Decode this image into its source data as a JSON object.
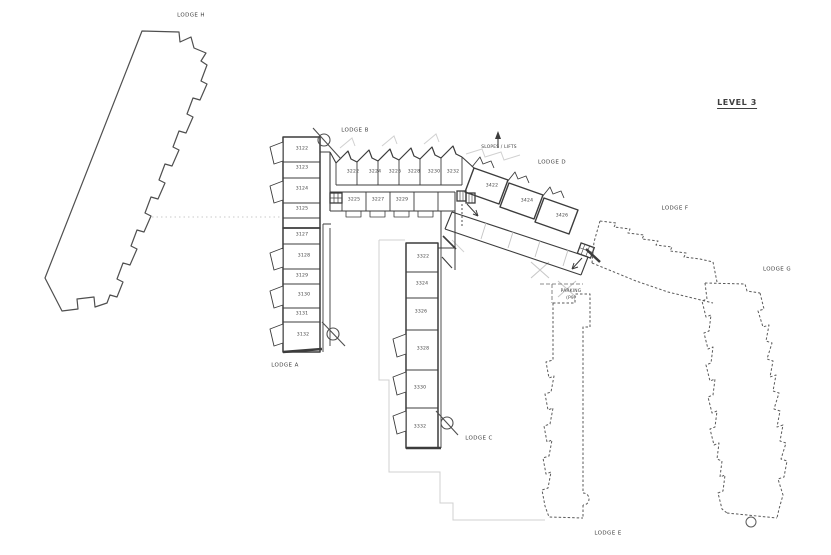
{
  "title": {
    "level_label": "LEVEL 3"
  },
  "lodges": {
    "a": "LODGE A",
    "b": "LODGE B",
    "c": "LODGE C",
    "d": "LODGE D",
    "e": "LODGE E",
    "f": "LODGE F",
    "g": "LODGE G",
    "h": "LODGE H"
  },
  "annotations": {
    "slopes_lifts": "SLOPES / LIFTS",
    "parking_line1": "PARKING",
    "parking_line2": "(P9)"
  },
  "rooms": {
    "lodge_b_left": [
      "3122",
      "3123",
      "3124",
      "3125"
    ],
    "lodge_b_top": [
      "3222",
      "3224",
      "3226",
      "3228",
      "3230",
      "3232"
    ],
    "lodge_b_bottom": [
      "3225",
      "3227",
      "3229"
    ],
    "lodge_a": [
      "3127",
      "3128",
      "3129",
      "3130",
      "3131",
      "3132"
    ],
    "lodge_c": [
      "3322",
      "3324",
      "3326",
      "3328",
      "3330",
      "3332"
    ],
    "lodge_d": [
      "3422",
      "3424",
      "3426"
    ]
  },
  "icons": {
    "stair_marker": "circle-slash-icon",
    "lift_marker": "lift-icon",
    "slopes_arrow": "arrow-up-icon"
  },
  "colors": {
    "line": "#4f4f4f",
    "line_dark": "#3c3c3c",
    "line_light": "#d0d0d0",
    "text": "#3f3f3f",
    "background": "#ffffff"
  }
}
